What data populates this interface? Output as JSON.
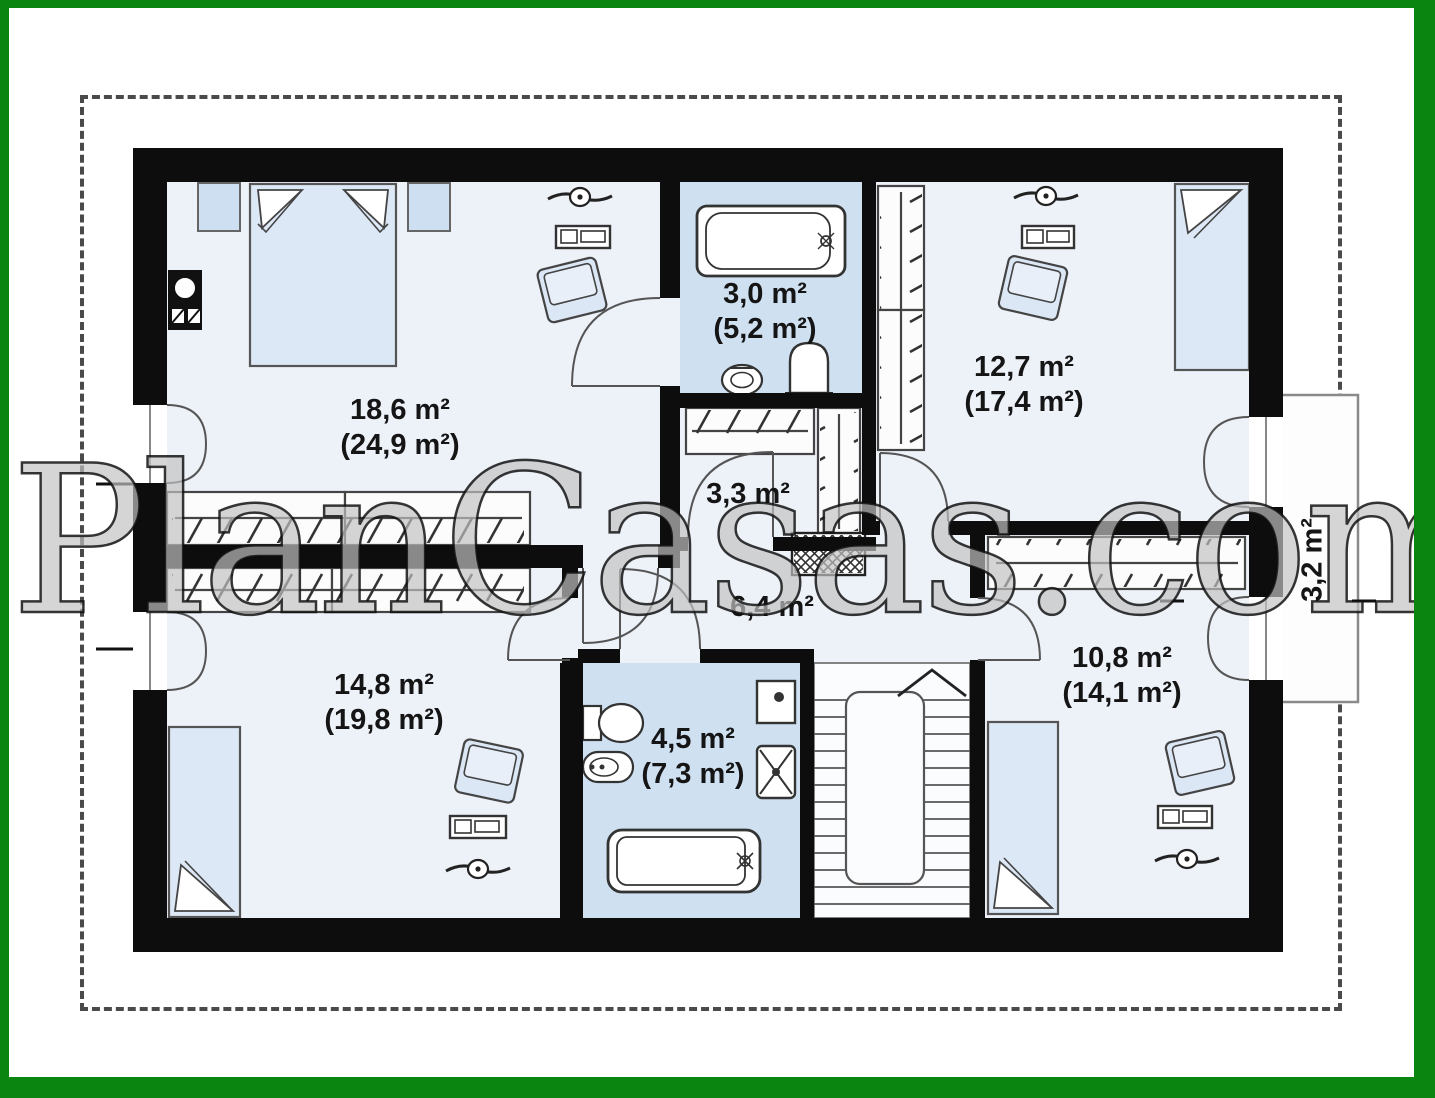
{
  "watermark": {
    "text": "PlanCasas.com"
  },
  "colors": {
    "frame_green": "#0a850f",
    "wall_black": "#0d0d0d",
    "room_fill": "#edf1f8",
    "bathroom_fill": "#cfe0f1",
    "furniture_fill": "#dde8f6"
  },
  "rooms": {
    "bedroom_top_left": {
      "area": "18,6 m²",
      "total": "(24,9 m²)"
    },
    "bathroom_top": {
      "area": "3,0 m²",
      "total": "(5,2 m²)"
    },
    "bedroom_top_right": {
      "area": "12,7 m²",
      "total": "(17,4 m²)"
    },
    "closet": {
      "area": "3,3 m²"
    },
    "hallway": {
      "area": "6,4 m²"
    },
    "balcony": {
      "area": "3,2 m²"
    },
    "bedroom_bottom_left": {
      "area": "14,8 m²",
      "total": "(19,8 m²)"
    },
    "bathroom_bottom": {
      "area": "4,5 m²",
      "total": "(7,3 m²)"
    },
    "bedroom_bottom_right": {
      "area": "10,8 m²",
      "total": "(14,1 m²)"
    }
  }
}
